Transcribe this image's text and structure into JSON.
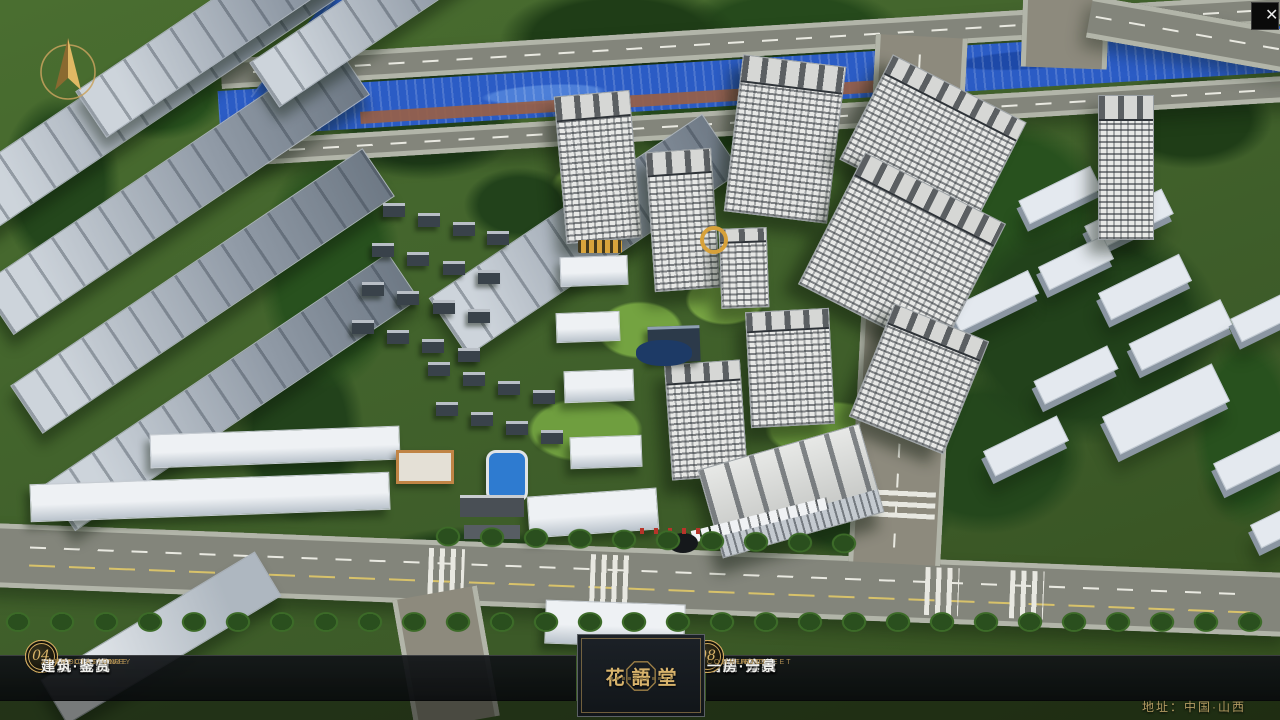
{
  "window": {
    "close_glyph": "✕"
  },
  "nav": {
    "items": [
      {
        "num": "01",
        "zh": "品牌·介绍",
        "en": "BRAND SUPPORT"
      },
      {
        "num": "02",
        "zh": "区位·价值",
        "en": "LOCATION VALUE"
      },
      {
        "num": "03",
        "zh": "项目·概况",
        "en": "PROJECT SURVEY"
      },
      {
        "num": "04",
        "zh": "建筑·鉴赏",
        "en": "APPRECIATION"
      },
      {
        "num": "05",
        "zh": "园林·景观",
        "en": "GARDEN STREET"
      },
      {
        "num": "06",
        "zh": "精装·体验",
        "en": "EXPERIENCE"
      },
      {
        "num": "07",
        "zh": "户型·分布",
        "en": "SHOW ROOM"
      },
      {
        "num": "08",
        "zh": "一房·一景",
        "en": "COMMUNITY"
      }
    ]
  },
  "logo": {
    "title": "花語堂"
  },
  "footer": {
    "address": "地址：中国·山西"
  },
  "colors": {
    "gold": "#c9a25e",
    "bar_bg": "#0b0e11",
    "river_blue": "#2b5cc5",
    "text_gold": "#d8b36c"
  }
}
